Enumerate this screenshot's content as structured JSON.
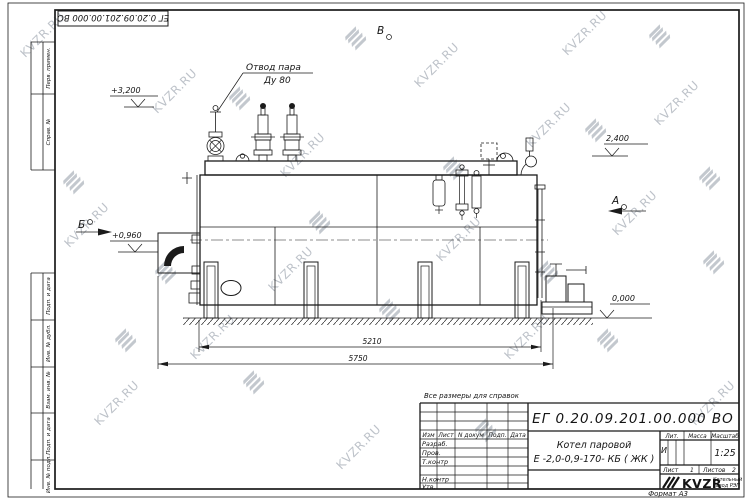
{
  "watermark": {
    "text": "KVZR.RU"
  },
  "stamp_top": {
    "doc_number": "ЕГ 0.20.09.201.00.000  ВО"
  },
  "margin": {
    "perv_primen": "Перв. примен.",
    "sprav_no": "Справ. №",
    "podp_data_1": "Подп. и дата",
    "inv_dubl": "Инв. № дубл.",
    "vzam_inv": "Взам. инв. №",
    "podp_data_2": "Подп. и дата",
    "inv_podl": "Инв. № подл."
  },
  "labels": {
    "steam_line1": "Отвод пара",
    "steam_line2": "Ду 80",
    "view_v": "В",
    "view_a": "А",
    "view_b": "Б",
    "elev_3200": "+3,200",
    "elev_2400": "2,400",
    "elev_0960": "+0,960",
    "elev_0000": "0,000",
    "dim_5210": "5210",
    "dim_5750": "5750",
    "note": "Все размеры для справок"
  },
  "tb": {
    "doc_number": "ЕГ 0.20.09.201.00.000  ВО",
    "product_line1": "Котел паровой",
    "product_line2": "Е -2,0-0,9-170- КБ ( ЖК )",
    "col_izm": "Изм",
    "col_list": "Лист",
    "col_ndokum": "N докум",
    "col_podp": "Подп.",
    "col_data": "Дата",
    "row_razrab": "Разраб.",
    "row_prov": "Пров.",
    "row_tkontr": "Т.контр",
    "row_nkontr": "Н.контр",
    "row_utv": "Утв.",
    "lit_label": "Лит.",
    "massa_label": "Масса",
    "masshtab_label": "Масштаб",
    "lit_value": "И",
    "scale_value": "1:25",
    "list_label": "Лист",
    "list_value": "1",
    "listov_label": "Листов",
    "listov_value": "2",
    "logo_text": "KVZR",
    "company_line1": "Котельный",
    "company_line2": "завод РЭП",
    "format_label": "Формат А3"
  }
}
